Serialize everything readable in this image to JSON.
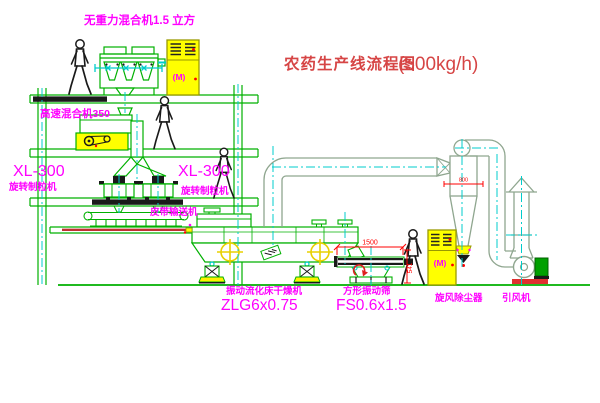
{
  "title": {
    "text_zh": "农药生产线流程图",
    "capacity": "(500kg/h)"
  },
  "equipment_labels": {
    "gravity_free_mixer": "无重力混合机1.5 立方",
    "high_speed_mixer": "高速混合机350",
    "granulator_left": {
      "model": "XL-300",
      "name": "旋转制粒机"
    },
    "granulator_center": {
      "model": "XL-300",
      "name": "旋转制粒机"
    },
    "belt_conveyor": "皮带输送机",
    "fluid_bed_dryer": {
      "name": "振动流化床干燥机",
      "model": "ZLG6x0.75"
    },
    "vibrating_screen": {
      "name": "方形振动筛",
      "model": "FS0.6x1.5"
    },
    "cyclone": "旋风除尘器",
    "induced_draft_fan": "引风机"
  },
  "dimensions": {
    "screen_length": "1500",
    "screen_height": "541",
    "cyclone_marking": "800"
  },
  "control_cabinets": {
    "upper_label": "(M)",
    "lower_label": "(M)"
  },
  "colors": {
    "line_green": "#00B000",
    "duct_gray": "#8FA68F",
    "centerline_cyan": "#00CCCC",
    "label_magenta": "#FF00FF",
    "title_red": "#D64545",
    "dimension_red": "#FF0000",
    "cabinet_yellow": "#FFFF00",
    "ink_black": "#1A1A1A"
  }
}
